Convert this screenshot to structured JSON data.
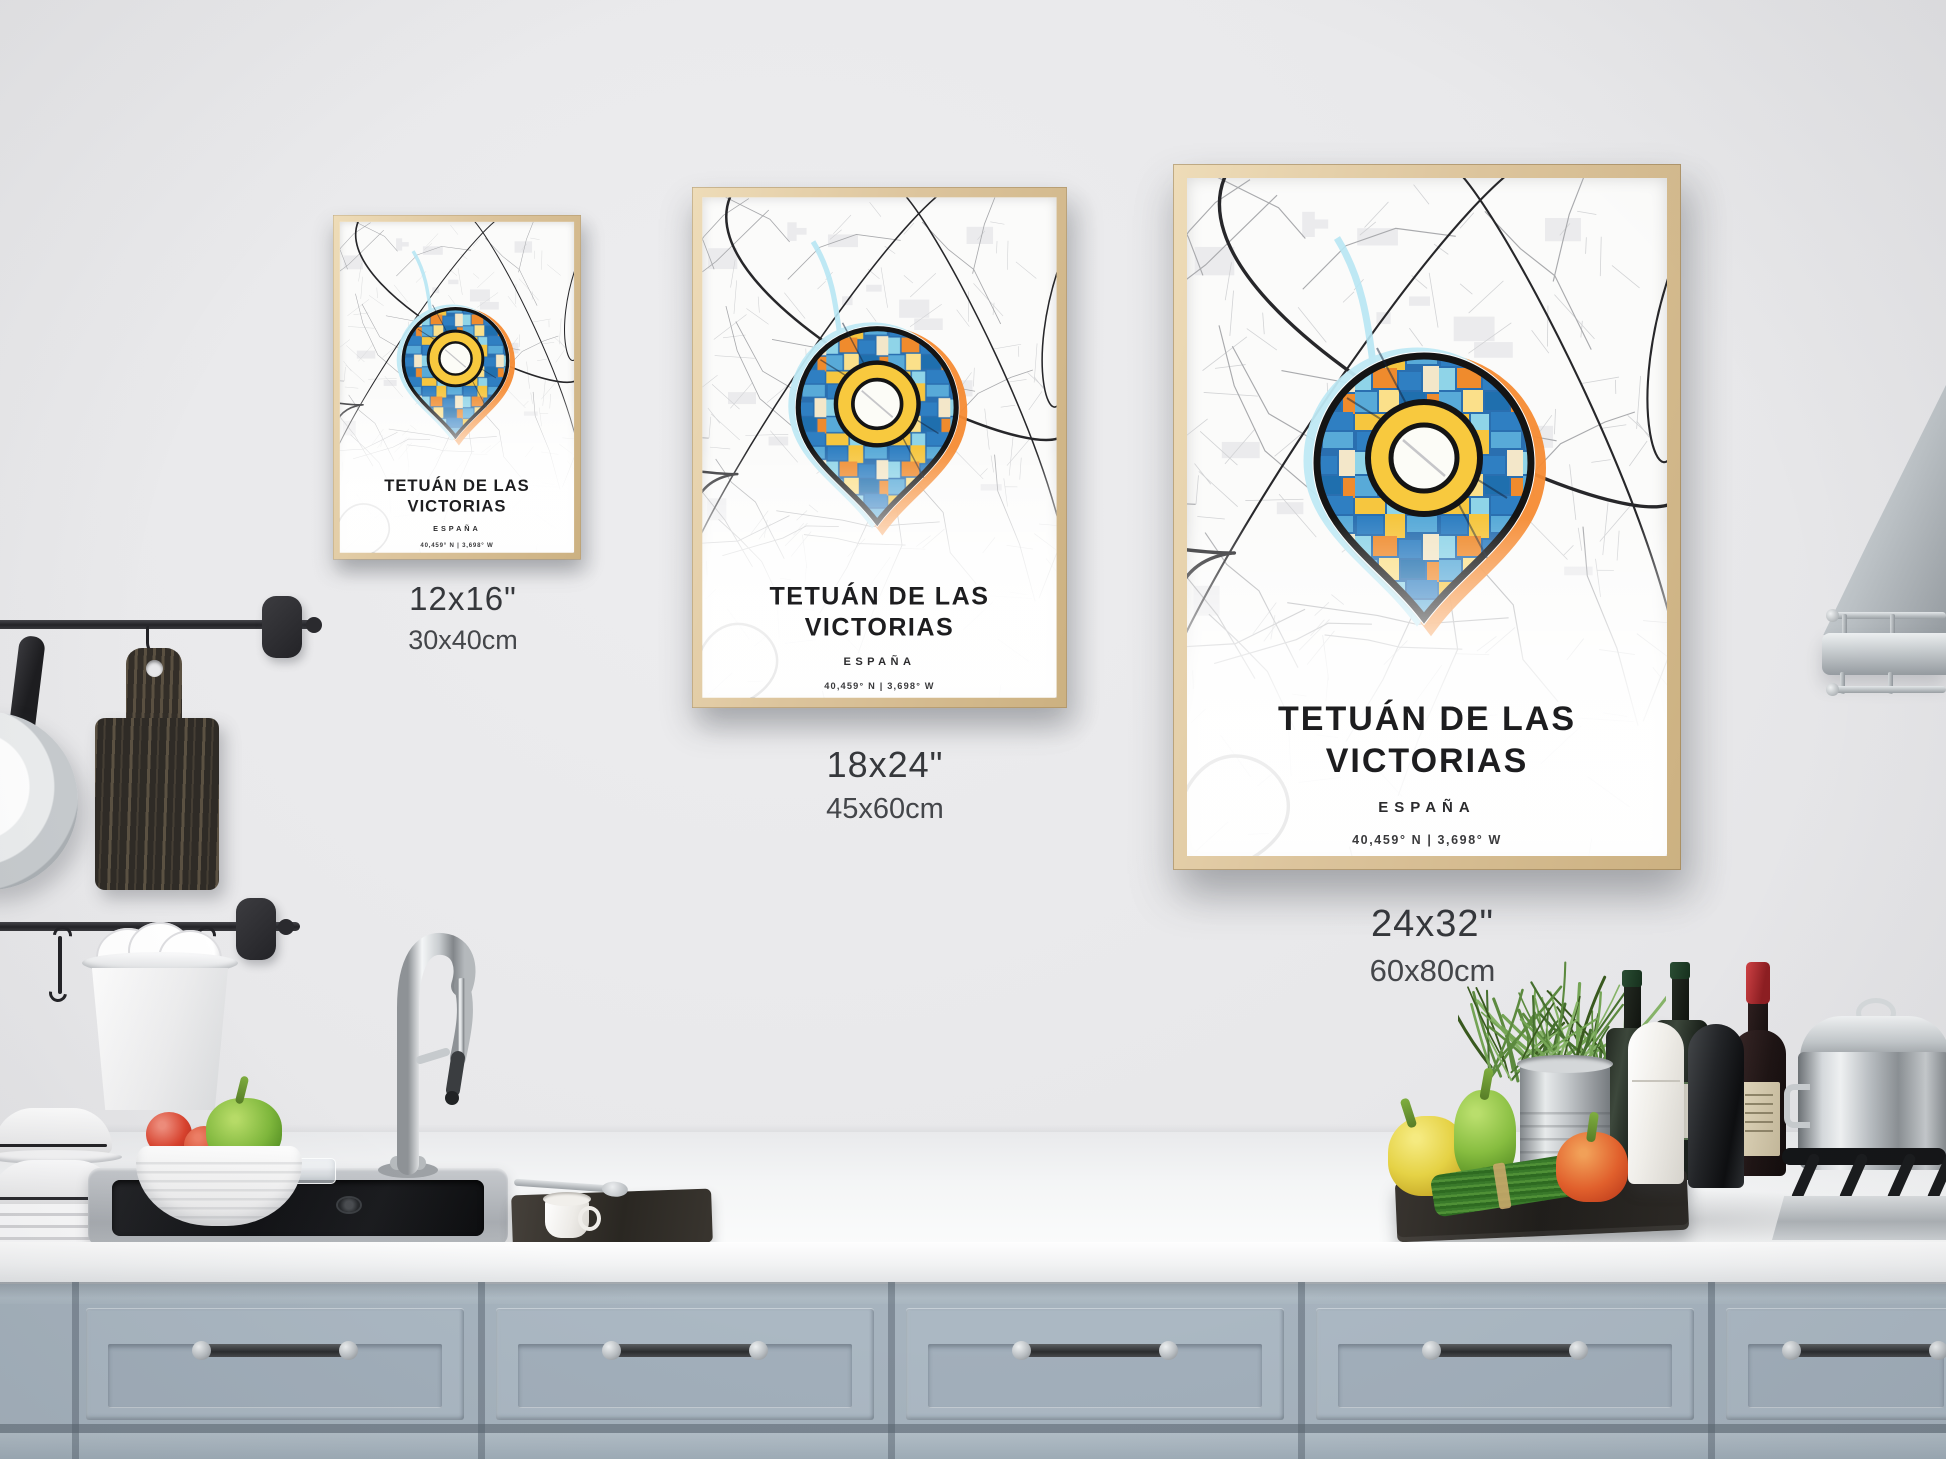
{
  "poster": {
    "title_line1": "TETUÁN DE LAS",
    "title_line2": "VICTORIAS",
    "subtitle": "ESPAÑA",
    "coordinates": "40,459° N | 3,698° W",
    "credit": "Design by HEBSTREIT. Map data supported by © OpenStreetMap contributors."
  },
  "sizes": [
    {
      "inches": "12x16\"",
      "cm": "30x40cm"
    },
    {
      "inches": "18x24\"",
      "cm": "45x60cm"
    },
    {
      "inches": "24x32\"",
      "cm": "60x80cm"
    }
  ],
  "colors": {
    "pin_blue": "#2f7fc2",
    "pin_light_blue": "#8fd4e8",
    "pin_orange": "#ef8b2d",
    "pin_yellow": "#f6c63f",
    "frame_wood": "#dcc49c",
    "cabinet": "#a6b3be",
    "wall": "#e9e9eb"
  }
}
